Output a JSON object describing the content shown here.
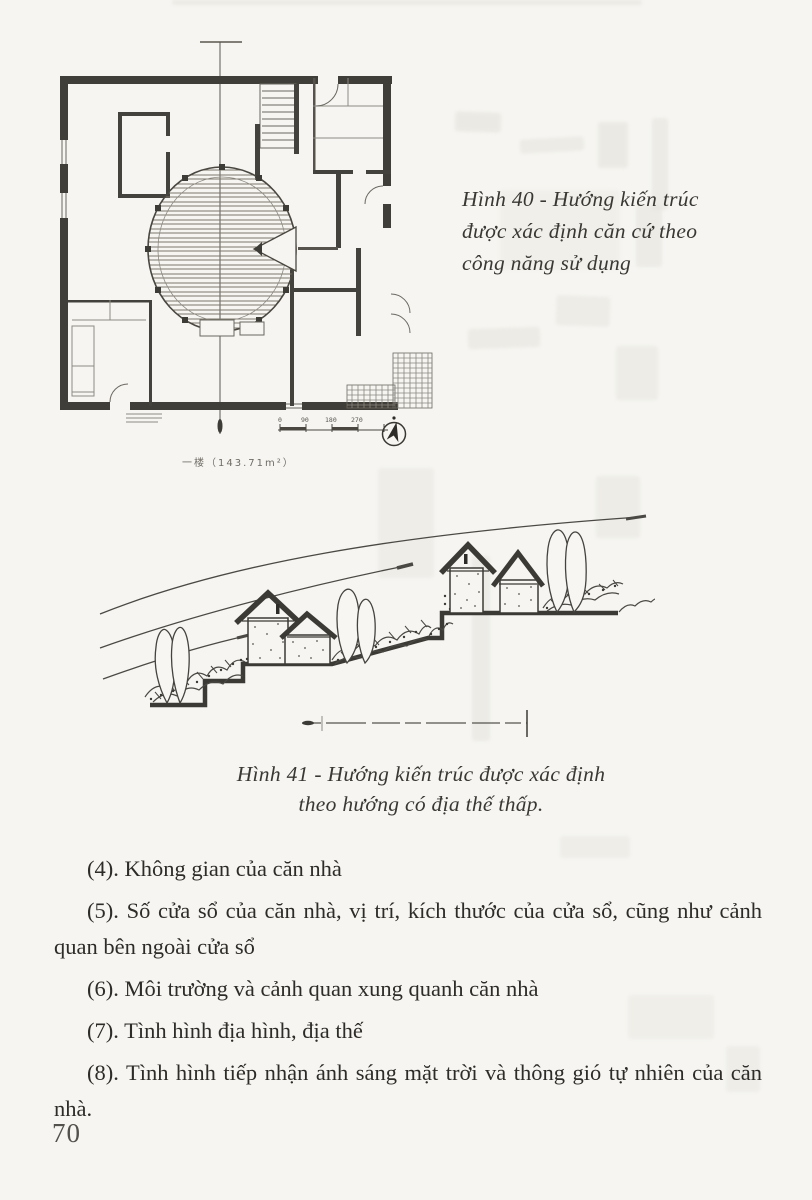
{
  "page": {
    "number": "70"
  },
  "figure40": {
    "caption": {
      "lines": [
        "Hình 40 - Hướng kiến trúc",
        "được xác định căn cứ theo",
        "công năng sử dụng"
      ]
    },
    "plan_area_label": "一楼（143.71m²）",
    "scale_ticks": [
      "0",
      "90",
      "180",
      "270"
    ]
  },
  "figure41": {
    "caption": {
      "lines": [
        "Hình 41 - Hướng kiến trúc được xác định",
        "theo hướng có địa thế thấp."
      ]
    }
  },
  "list": {
    "items": [
      {
        "label": "(4).",
        "text": "Không gian của căn nhà"
      },
      {
        "label": "(5).",
        "text": "Số cửa sổ của căn nhà, vị trí, kích thước của cửa sổ, cũng như cảnh quan bên ngoài cửa sổ"
      },
      {
        "label": "(6).",
        "text": "Môi trường và cảnh quan xung quanh căn nhà"
      },
      {
        "label": "(7).",
        "text": "Tình hình địa hình, địa thế"
      },
      {
        "label": "(8).",
        "text": "Tình hình tiếp nhận ánh sáng mặt trời và thông gió tự nhiên của căn nhà."
      }
    ]
  },
  "colors": {
    "ink": "#2e2c28",
    "wall": "#403e38",
    "thin": "#6b6860",
    "ghost": "#e1dfd8"
  }
}
